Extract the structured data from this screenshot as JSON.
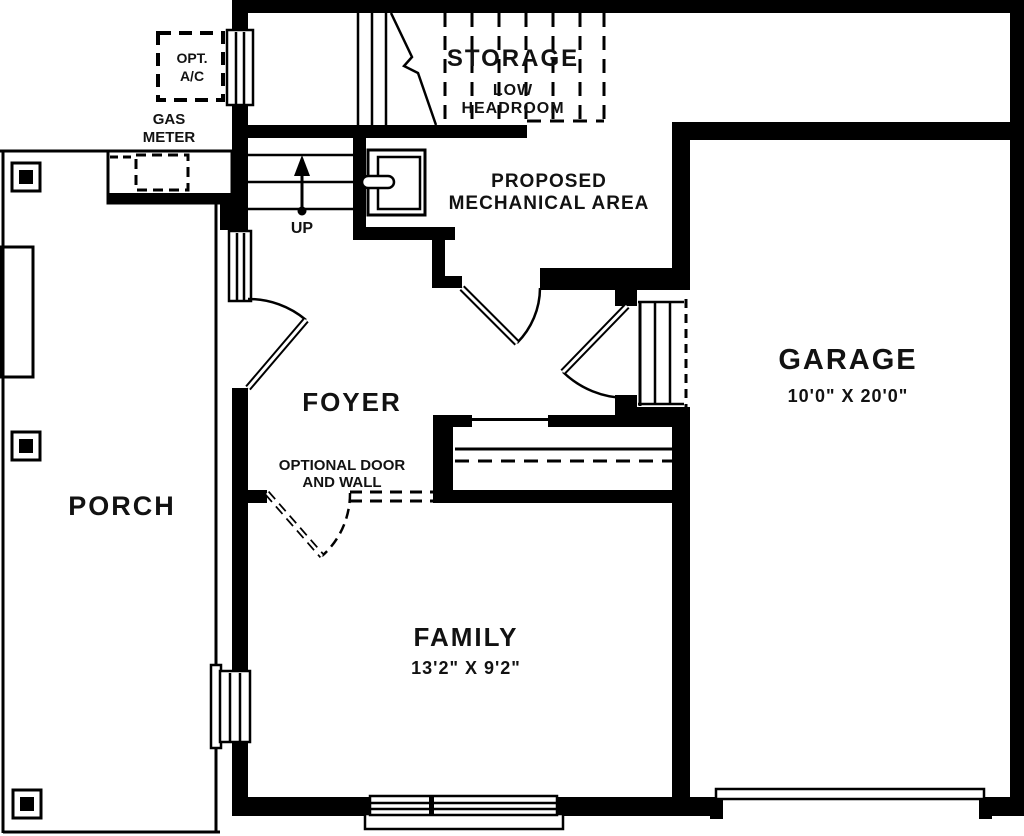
{
  "colors": {
    "wall": "#000000",
    "text": "#121212",
    "background": "#ffffff"
  },
  "rooms": {
    "storage": {
      "label": "STORAGE",
      "note1": "LOW",
      "note2": "HEADROOM"
    },
    "mechanical": {
      "label1": "PROPOSED",
      "label2": "MECHANICAL AREA"
    },
    "garage": {
      "label": "GARAGE",
      "dims": "10'0\" X 20'0\""
    },
    "foyer": {
      "label": "FOYER"
    },
    "porch": {
      "label": "PORCH"
    },
    "family": {
      "label": "FAMILY",
      "dims": "13'2\" X 9'2\""
    }
  },
  "annotations": {
    "opt_ac1": "OPT.",
    "opt_ac2": "A/C",
    "gas1": "GAS",
    "gas2": "METER",
    "optional_door1": "OPTIONAL DOOR",
    "optional_door2": "AND WALL",
    "up": "UP"
  }
}
